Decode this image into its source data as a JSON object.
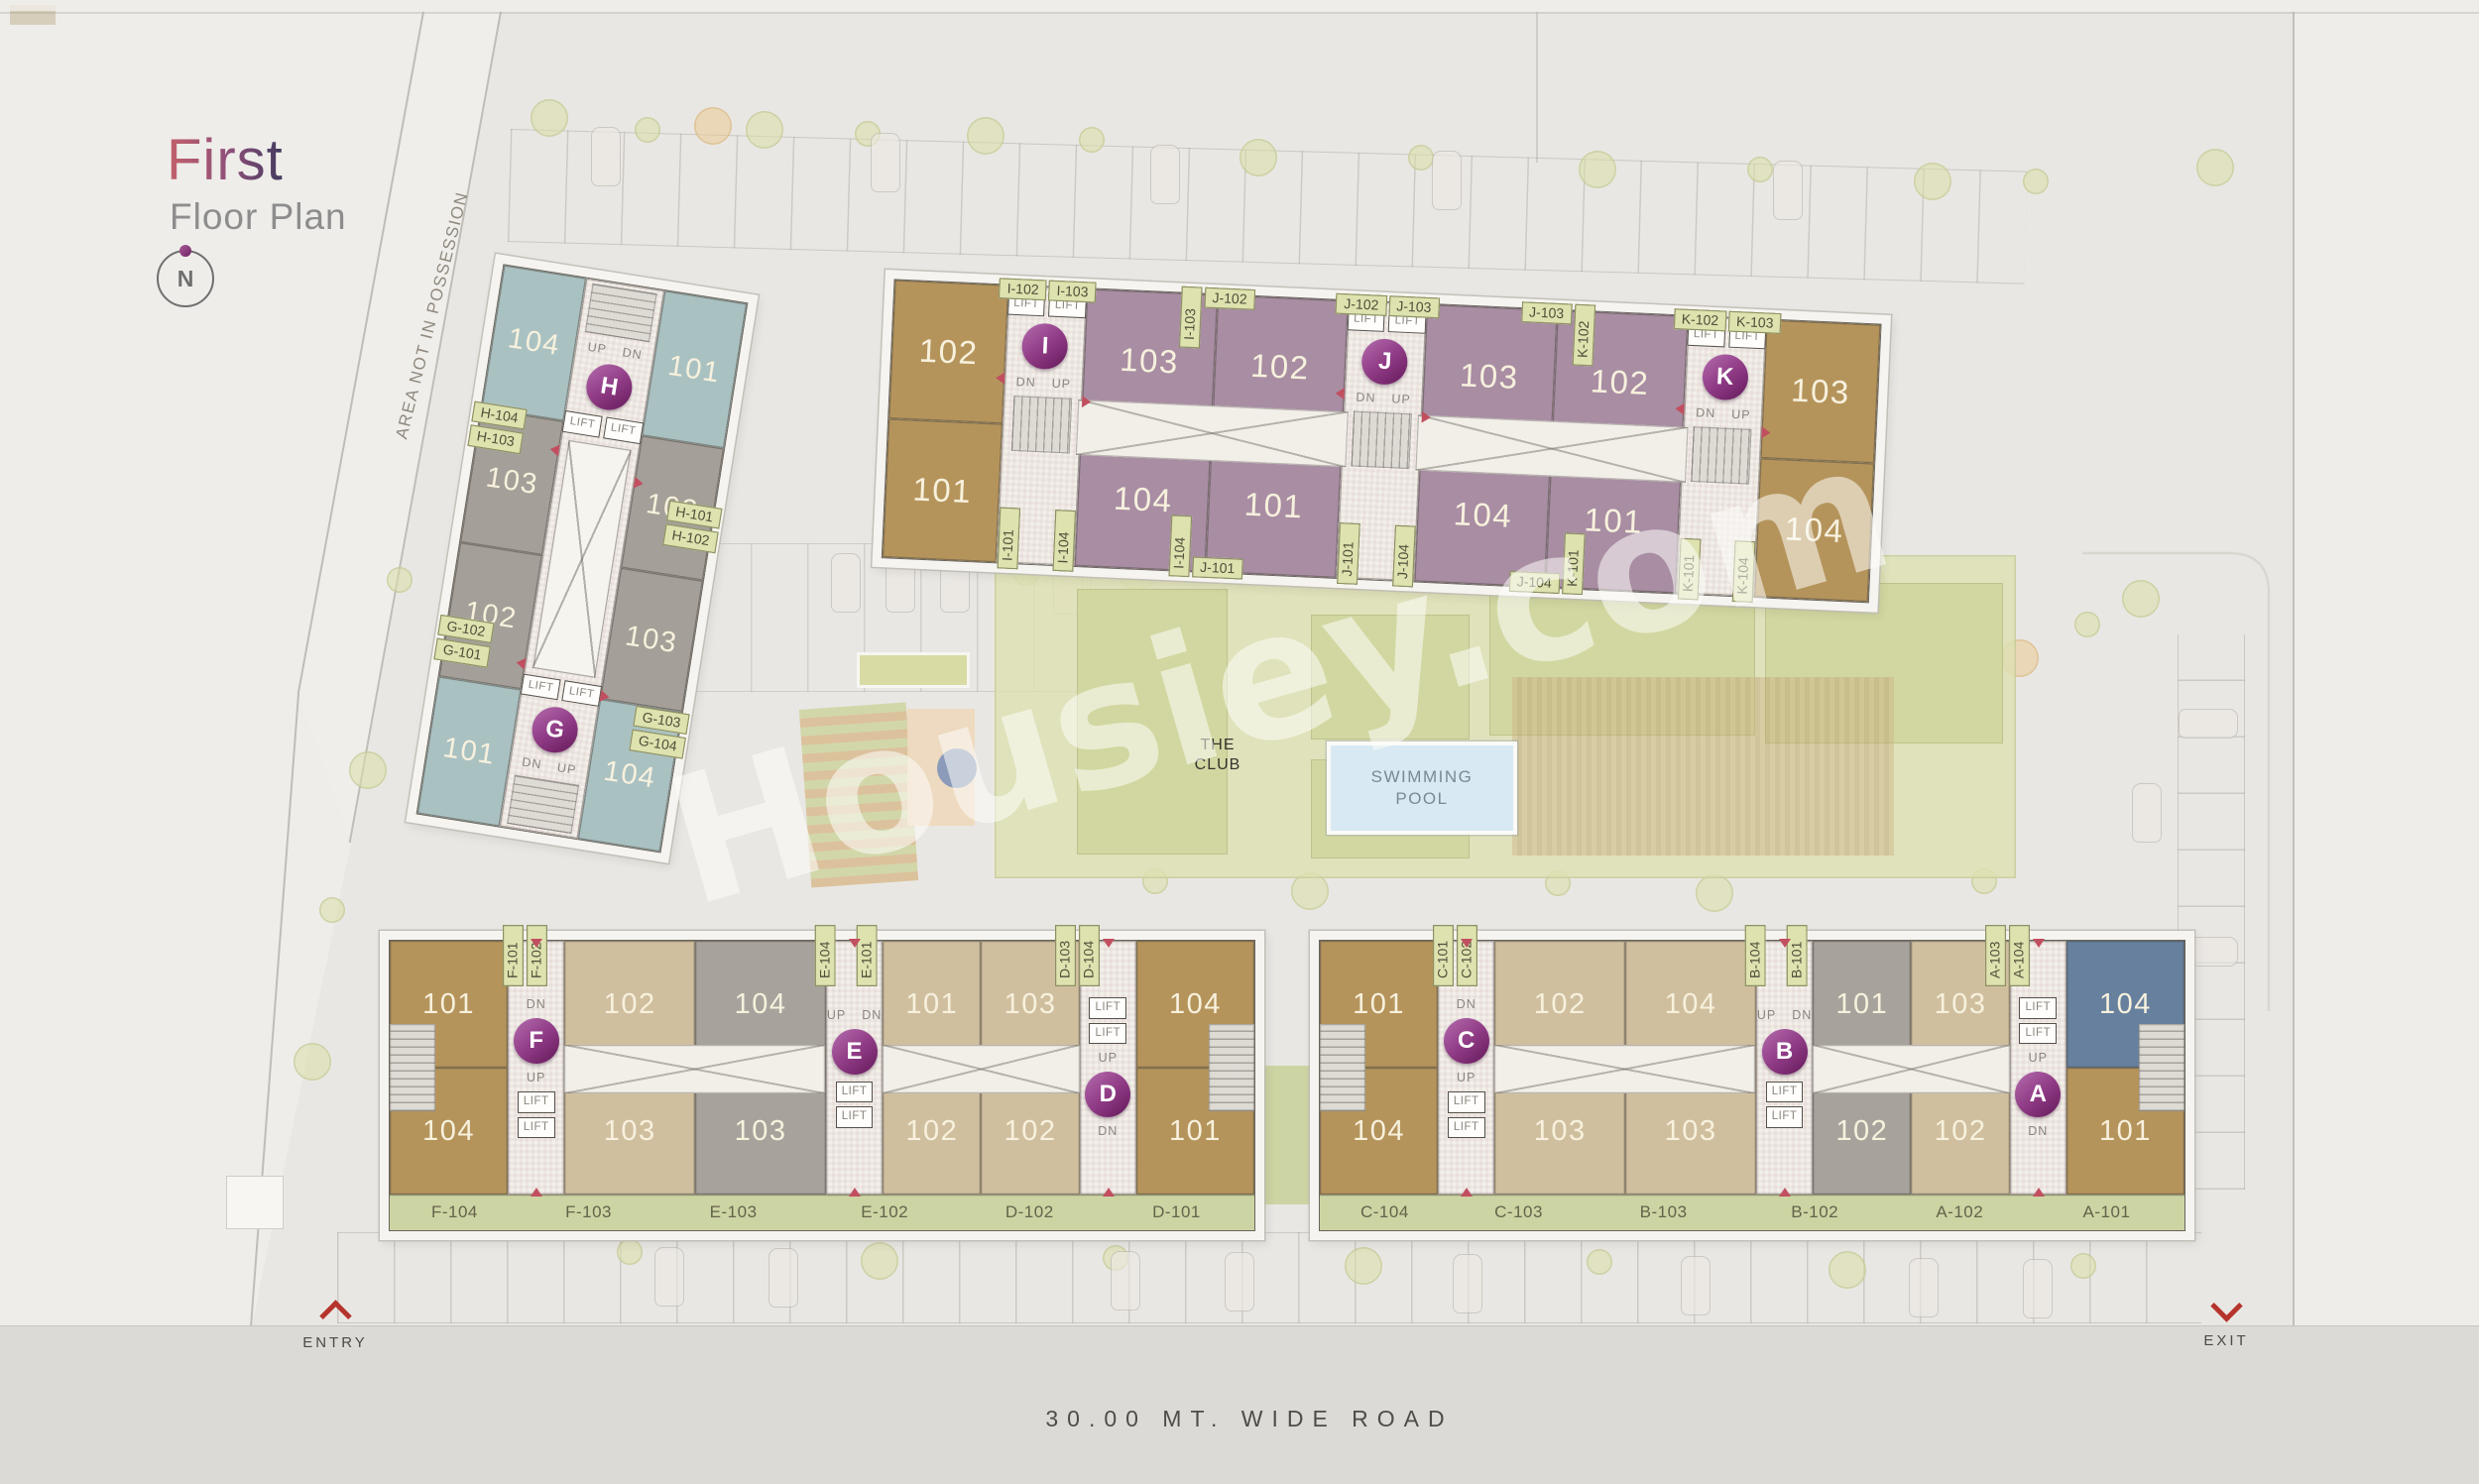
{
  "header": {
    "title": "First",
    "subtitle": "Floor Plan",
    "compass_n": "N"
  },
  "site": {
    "area_note": "AREA NOT IN POSSESSION",
    "club_line1": "THE",
    "club_line2": "CLUB",
    "pool_line1": "SWIMMING",
    "pool_line2": "POOL",
    "entry": "ENTRY",
    "exit": "EXIT",
    "road": "30.00  MT.  WIDE  ROAD",
    "watermark": "Housiey.com"
  },
  "common": {
    "lift": "LIFT",
    "up": "UP",
    "dn": "DN"
  },
  "colors": {
    "teal": "#aac1c2",
    "warm_gray": "#a49f98",
    "tan": "#b5945c",
    "mauve": "#a88da3",
    "beige": "#d0bf9f",
    "cool_gray": "#a7a39c",
    "slate_blue": "#66809e",
    "tag_green": "#dee2af",
    "band_green": "#cdd4a3",
    "badge_purple": "#903c86",
    "arrow_red": "#c14f60",
    "pool_blue": "#d8e9f3",
    "title_accent": "#c4606b"
  },
  "hg": {
    "h": {
      "letter": "H",
      "u_tl": "104",
      "u_tr": "101",
      "u_bl": "103",
      "u_br": "102",
      "tags_left": [
        "H-104",
        "H-103"
      ],
      "tags_right": [
        "H-101",
        "H-102"
      ]
    },
    "g": {
      "letter": "G",
      "u_tl": "102",
      "u_tr": "103",
      "u_bl": "101",
      "u_br": "104",
      "tags_left": [
        "G-102",
        "G-101"
      ],
      "tags_right": [
        "G-103",
        "G-104"
      ]
    }
  },
  "top": {
    "end_l_top": "102",
    "end_l_bot": "101",
    "i": {
      "letter": "I",
      "tag_tl": "I-102",
      "tag_tr": "I-103",
      "tag_bl": "I-101",
      "tag_br": "I-104"
    },
    "i_units_top": "103",
    "i_units_bot": "104",
    "b1": {
      "top_v": "I-103",
      "top_h": "J-102",
      "bot_v": "I-104",
      "bot_h": "J-101"
    },
    "j_left_top": "102",
    "j_left_bot": "101",
    "j": {
      "letter": "J",
      "tag_tl": "J-102",
      "tag_tr": "J-103",
      "tag_bl": "J-101",
      "tag_br": "J-104"
    },
    "j_units_top": "103",
    "j_units_bot": "104",
    "b2": {
      "top_h": "J-103",
      "top_v": "K-102",
      "bot_h": "J-104",
      "bot_v": "K-101"
    },
    "k_left_top": "102",
    "k_left_bot": "101",
    "k": {
      "letter": "K",
      "tag_tl": "K-102",
      "tag_tr": "K-103",
      "tag_bl": "K-101",
      "tag_br": "K-104"
    },
    "end_r_top": "103",
    "end_r_bot": "104"
  },
  "bl": {
    "end_l_top": "101",
    "end_l_bot": "104",
    "f": {
      "letter": "F",
      "tag1": "F-101",
      "tag2": "F-102"
    },
    "f_units_top": "102",
    "f_units_bot": "103",
    "e_pre_tag": "E-104",
    "e_pre_top": "104",
    "e_pre_bot": "103",
    "e": {
      "letter": "E",
      "tag1": "E-101"
    },
    "e_units_top": "101",
    "e_units_bot": "102",
    "d_pre_top": "103",
    "d_pre_bot": "102",
    "d": {
      "letter": "D",
      "tag1": "D-103",
      "tag2": "D-104"
    },
    "end_r_top": "104",
    "end_r_bot": "101",
    "band": [
      "F-104",
      "F-103",
      "E-103",
      "E-102",
      "D-102",
      "D-101"
    ]
  },
  "br": {
    "end_l_top": "101",
    "end_l_bot": "104",
    "c": {
      "letter": "C",
      "tag1": "C-101",
      "tag2": "C-102"
    },
    "c_units_top": "102",
    "c_units_bot": "103",
    "b_pre_tag": "B-104",
    "b_pre_top": "104",
    "b_pre_bot": "103",
    "b": {
      "letter": "B",
      "tag1": "B-101"
    },
    "b_units_top": "101",
    "b_units_bot": "102",
    "a_pre_top": "103",
    "a_pre_bot": "102",
    "a": {
      "letter": "A",
      "tag1": "A-103",
      "tag2": "A-104"
    },
    "end_r_top": "104",
    "end_r_bot": "101",
    "band": [
      "C-104",
      "C-103",
      "B-103",
      "B-102",
      "A-102",
      "A-101"
    ]
  }
}
